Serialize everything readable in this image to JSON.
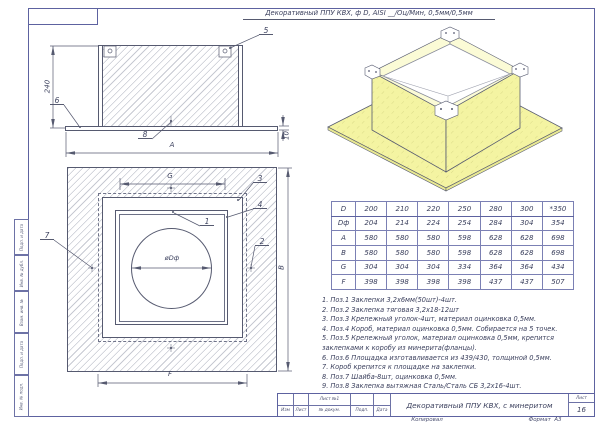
{
  "drawing": {
    "header_title": "Декоративный ППУ КВХ, ф D, AISI __/Оц/Мин, 0,5мм/0,5мм"
  },
  "margin": {
    "fields": [
      "Подп. и дата",
      "Инв. № дубл.",
      "Взам. инв. №",
      "Подп. и дата",
      "Инв. № подл."
    ]
  },
  "side_view": {
    "dim_height": "240",
    "dim_width": "A",
    "dim_plate": "10",
    "callout_5": "5",
    "callout_6": "6",
    "callout_8": "8"
  },
  "front_view": {
    "dim_top": "G",
    "dim_right": "B",
    "dim_bottom": "F",
    "dim_circle": "øDф",
    "callout_1": "1",
    "callout_2": "2",
    "callout_3": "3",
    "callout_4": "4",
    "callout_7": "7"
  },
  "size_table": {
    "rows": [
      {
        "label": "D",
        "values": [
          "200",
          "210",
          "220",
          "250",
          "280",
          "300",
          "*350"
        ]
      },
      {
        "label": "Dф",
        "values": [
          "204",
          "214",
          "224",
          "254",
          "284",
          "304",
          "354"
        ]
      },
      {
        "label": "A",
        "values": [
          "580",
          "580",
          "580",
          "598",
          "628",
          "628",
          "698"
        ]
      },
      {
        "label": "B",
        "values": [
          "580",
          "580",
          "580",
          "598",
          "628",
          "628",
          "698"
        ]
      },
      {
        "label": "G",
        "values": [
          "304",
          "304",
          "304",
          "334",
          "364",
          "364",
          "434"
        ]
      },
      {
        "label": "F",
        "values": [
          "398",
          "398",
          "398",
          "398",
          "437",
          "437",
          "507"
        ]
      }
    ]
  },
  "notes": [
    "1. Поз.1 Заклепки 3,2х6мм(50шт)-4шт.",
    "2. Поз.2 Заклепка тяговая 3,2х18-12шт",
    "3. Поз.3 Крепежный уголок-4шт, материал оцинковка 0,5мм.",
    "4. Поз.4 Короб, материал оцинковка 0,5мм. Собирается на 5 точек.",
    "5. Поз.5 Крепежный уголок, материал оцинковка 0,5мм, крепится заклепками к коробу из минерита(фланцы).",
    "6. Поз.6 Площадка изготавливается из 439/430, толщиной 0,5мм.",
    "7. Короб крепится к площадке на заклепки.",
    "8. Поз.7 Шайба-8шт, оцинковка 0,5мм.",
    "9. Поз.8 Заклепка вытяжная Сталь/Сталь СБ 3,2х16-4шт."
  ],
  "title_block": {
    "row_labels": [
      "Изм",
      "Лист",
      "№ докум.",
      "Подп.",
      "Дата"
    ],
    "sheet_ref": "Лист №1",
    "doc_title": "Декоративный ППУ КВХ, с минеритом",
    "sheet_label": "Лист",
    "sheet_value": "16",
    "copied_label": "Копировал",
    "format_label": "Формат",
    "format_value": "А3"
  },
  "colors": {
    "frame": "#5d62a0",
    "line": "#565a70",
    "text": "#3c415e",
    "fill_yellow": "#f4f4a2"
  }
}
